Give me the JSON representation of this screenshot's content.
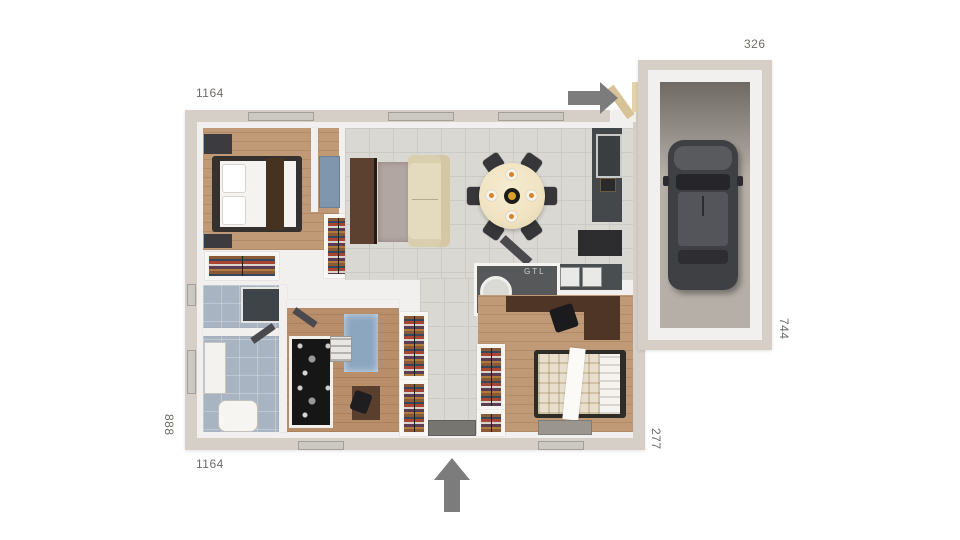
{
  "floorplan": {
    "dimensions": {
      "top_width": "1164",
      "bottom_width": "1164",
      "left_depth": "888",
      "garage_top_width": "326",
      "garage_right_depth": "744",
      "bottom_right_offset": "277"
    },
    "labels": {
      "technical_duct": "GTL"
    },
    "icons": {
      "top_entrance": "arrow-right-icon",
      "bottom_entrance": "arrow-up-icon"
    },
    "colors": {
      "background": "#ffffff",
      "outer_wall": "#d6cfc7",
      "inner_wall": "#f2f0ee",
      "tile_floor": "#d9d8d3",
      "wood_floor": "#c09a76",
      "bathroom_floor": "#a9b4c2",
      "garage_floor": "#b5afa8",
      "arrow": "#7c7c7c",
      "dimension_text": "#6f6b67",
      "kitchen_counter": "#44484b",
      "sofa": "#e4dabe",
      "dining_table": "#f0e3c2",
      "car_body": "#3f4044",
      "door_leaf_tan": "#d8c298"
    }
  }
}
